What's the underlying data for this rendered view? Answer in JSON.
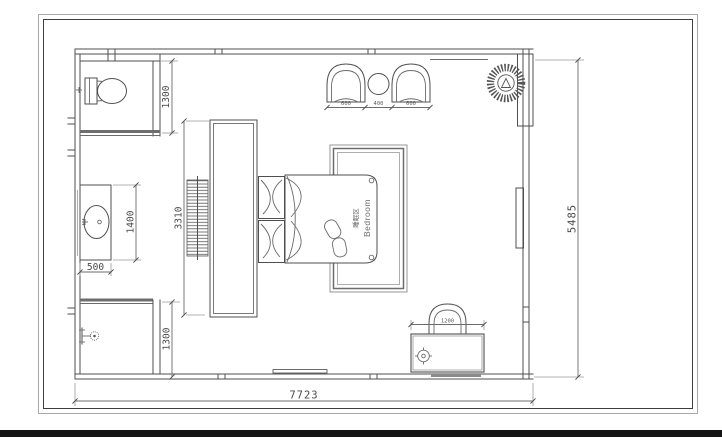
{
  "sheet": {
    "paper_color": "#ffffff",
    "frame_outer_color": "#a8a8a8",
    "frame_inner_color": "#3e3e3e",
    "ink_color": "#4f4f4f",
    "footer_bar_color": "#151515"
  },
  "room": {
    "label_zh": "睡眠区",
    "label_en": "Bedroom"
  },
  "dimensions": {
    "overall_width": "7723",
    "overall_height": "5485",
    "toilet_zone_depth": "1300",
    "shower_zone_depth": "1300",
    "vanity_length": "1400",
    "vanity_depth": "500",
    "wardrobe_length": "3310",
    "left_armchair_width": "600",
    "side_table_width": "400",
    "right_armchair_width": "600",
    "dressing_desk_width": "1200"
  }
}
